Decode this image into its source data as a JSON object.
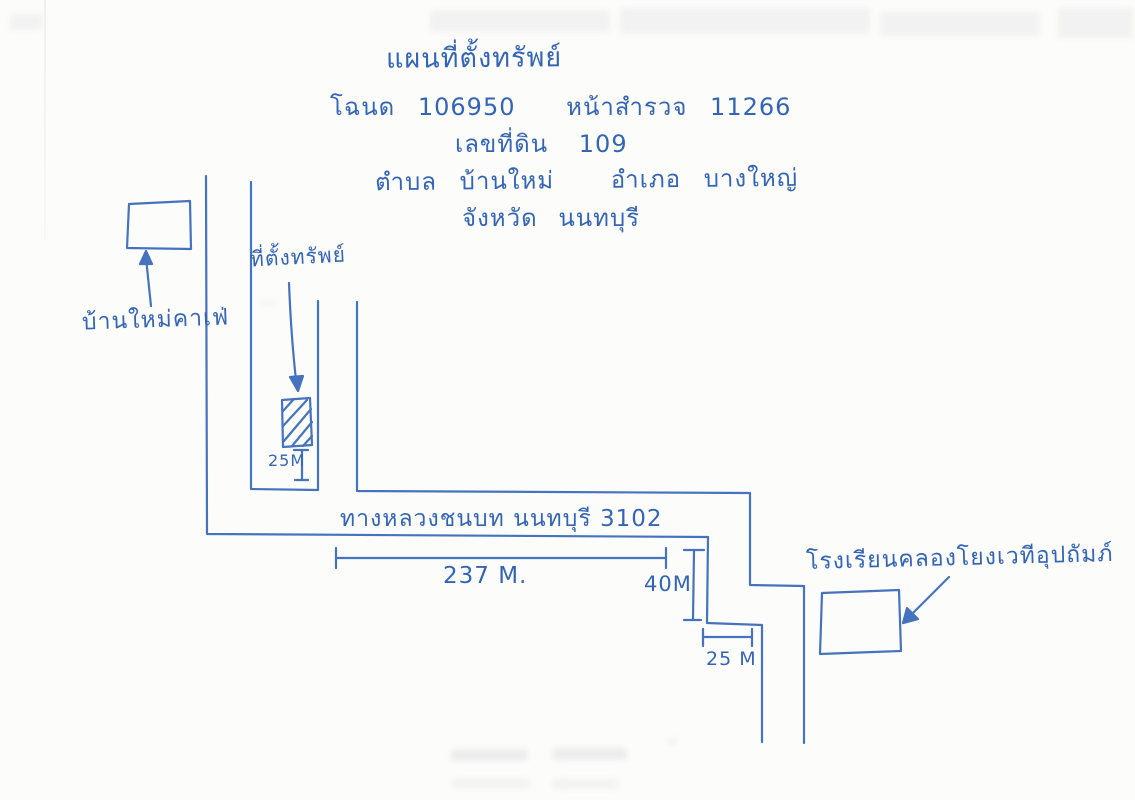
{
  "document": {
    "title": "แผนที่ตั้งทรัพย์",
    "deed": {
      "label": "โฉนด",
      "number": "106950"
    },
    "survey_page": {
      "label": "หน้าสำรวจ",
      "number": "11266"
    },
    "parcel": {
      "label": "เลขที่ดิน",
      "number": "109"
    },
    "subdistrict": {
      "label": "ตำบล",
      "name": "บ้านใหม่"
    },
    "district": {
      "label": "อำเภอ",
      "name": "บางใหญ่"
    },
    "province": {
      "label": "จังหวัด",
      "name": "นนทบุรี"
    }
  },
  "map": {
    "landmarks": {
      "cafe": "บ้านใหม่คาเฟ่",
      "property": "ที่ตั้งทรัพย์",
      "school": "โรงเรียนคลองโยงเวทีอุปถัมภ์",
      "road": "ทางหลวงชนบท นนทบุรี 3102"
    },
    "measurements": {
      "property_setback": "25M",
      "road_length": "237 M.",
      "road_width": "40M",
      "side_width": "25 M"
    },
    "ink_color": "#4471bd",
    "paper_color": "#fcfcfb"
  }
}
